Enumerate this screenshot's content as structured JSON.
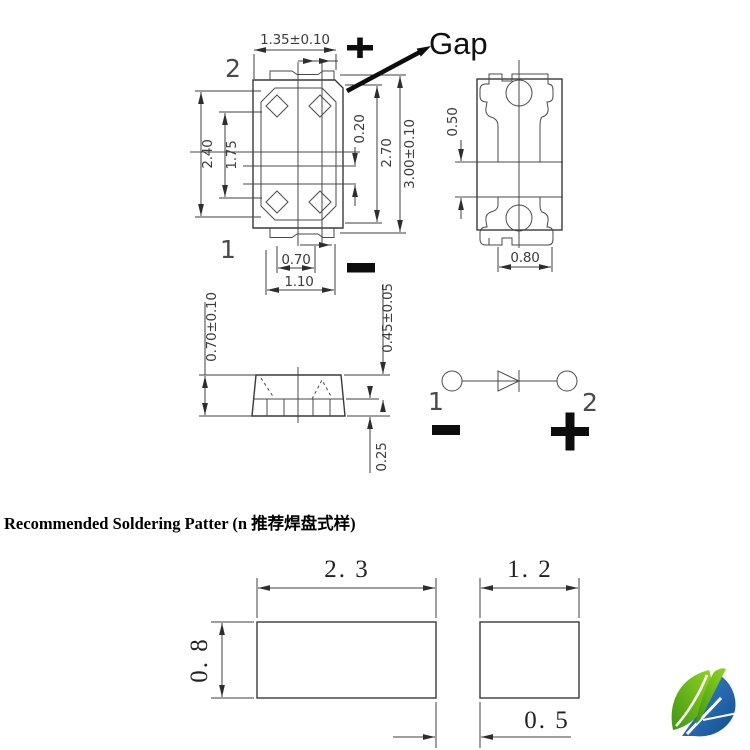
{
  "top_view": {
    "pin2_label": "2",
    "pin1_label": "1",
    "gap_label": "Gap",
    "dim_width_top": "1.35±0.10",
    "dim_cavity_height": "2.40",
    "dim_cavity_inner_height": "1.75",
    "dim_mid_gap": "0.20",
    "dim_body_height": "2.70",
    "dim_total_height": "3.00±0.10",
    "dim_pad_inner_width": "0.70",
    "dim_pad_outer_width": "1.10"
  },
  "bottom_view": {
    "dim_pad_gap": "0.50",
    "dim_pad_width": "0.80"
  },
  "side_view": {
    "dim_total_thickness": "0.70±0.10",
    "dim_body_thickness": "0.45±0.05",
    "dim_lead_thickness": "0.25"
  },
  "circuit": {
    "pin1_label": "1",
    "pin2_label": "2"
  },
  "soldering": {
    "title": "Recommended Soldering Patter (n 推荐焊盘式样)",
    "dim_left_pad_width": "2. 3",
    "dim_right_pad_width": "1. 2",
    "dim_pad_height": "0. 8",
    "dim_pad_gap": "0. 5"
  },
  "logo": {
    "green": "#6ab82e",
    "blue": "#1d64ae"
  }
}
